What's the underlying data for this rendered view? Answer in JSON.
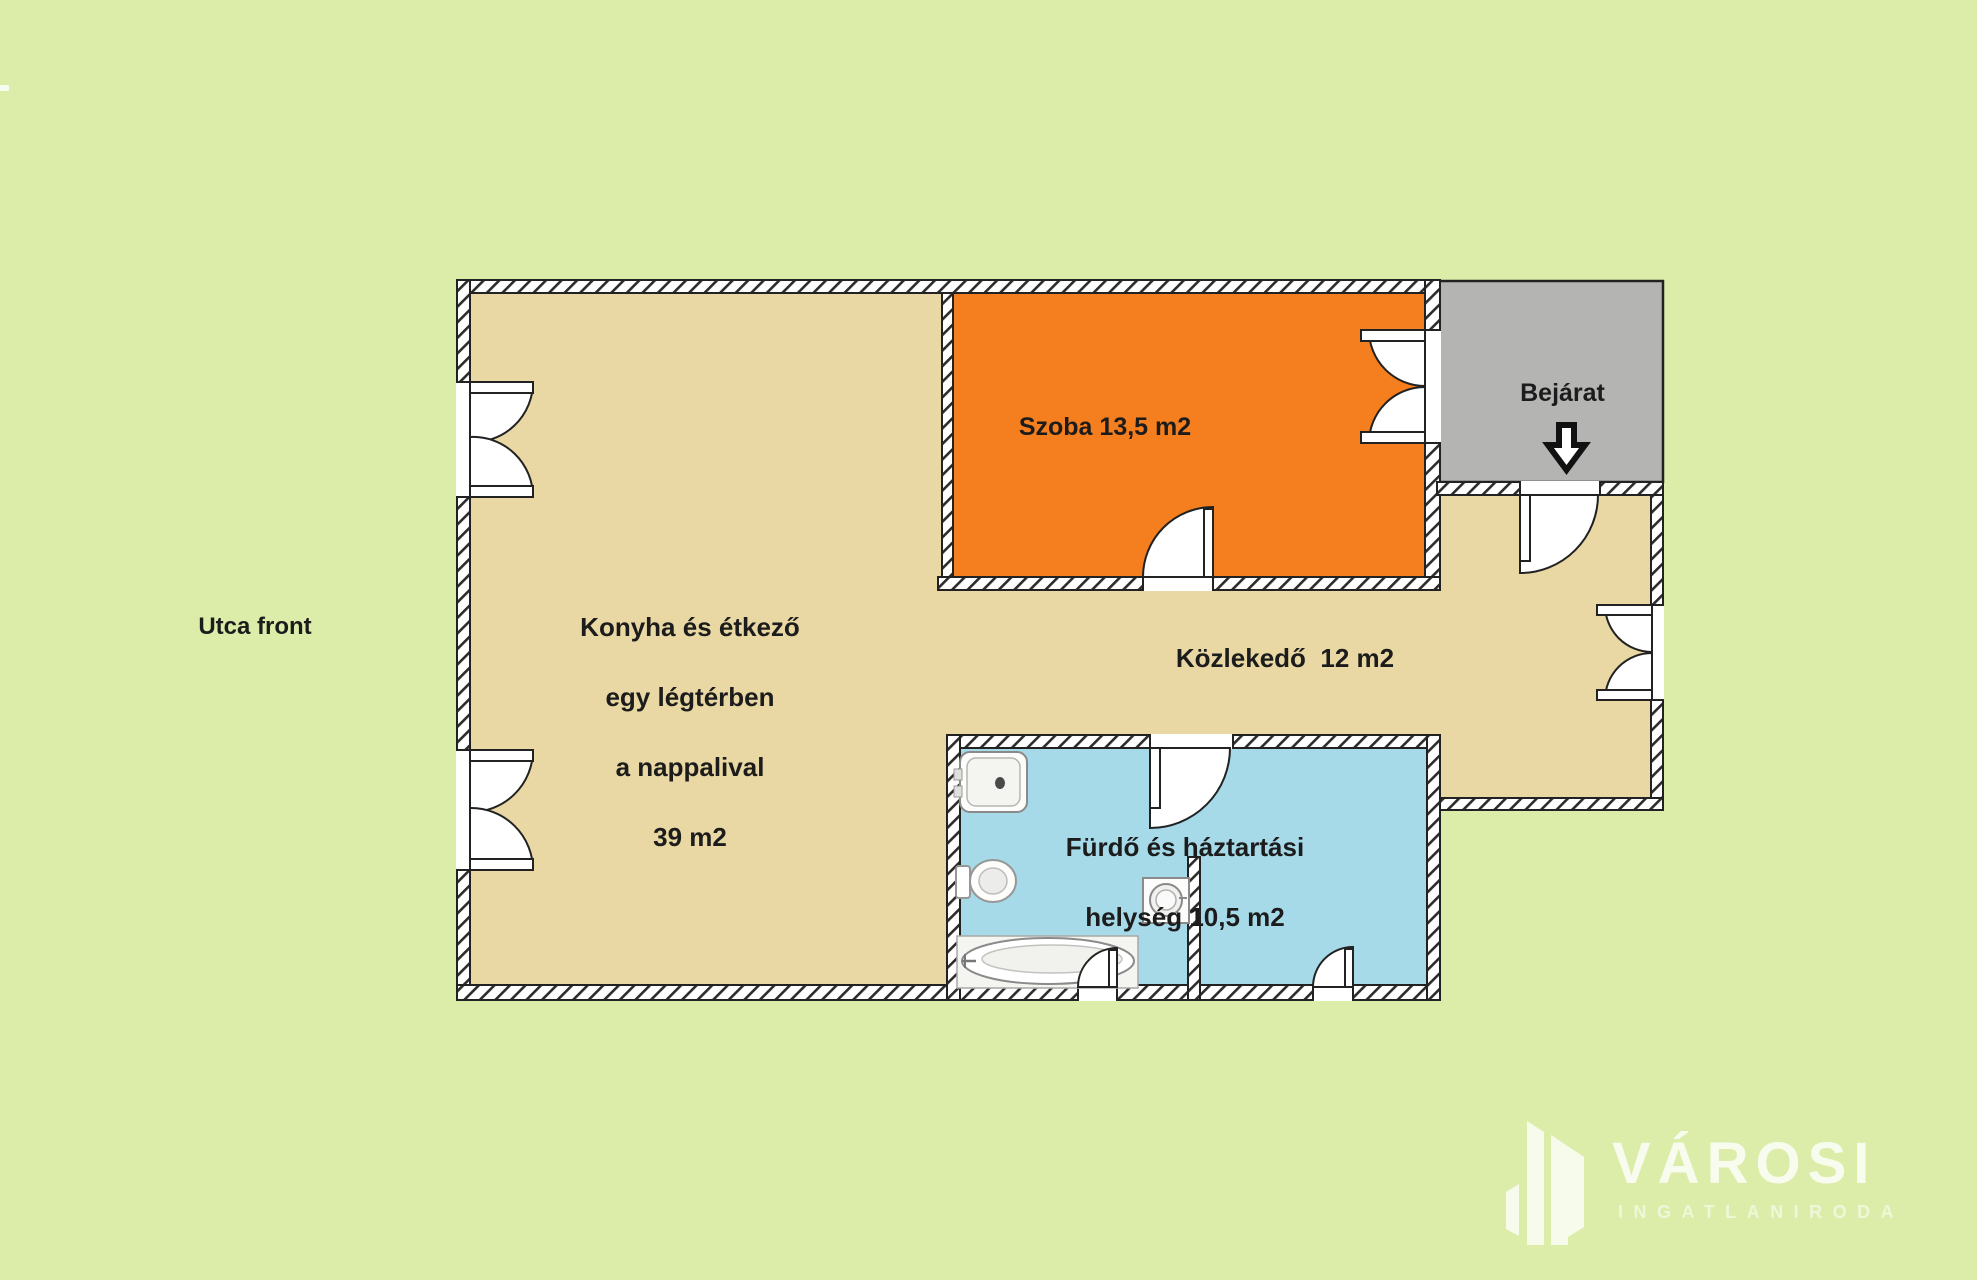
{
  "plan_title": "apartment floor plan",
  "outside": {
    "street_front_label": "Utca front"
  },
  "rooms": {
    "konyha": {
      "label_lines": [
        "Konyha és étkező",
        "egy légtérben",
        "a nappalival",
        "39 m2"
      ],
      "area_m2": "39",
      "color": "#e9d8a3"
    },
    "szoba": {
      "label": "Szoba 13,5 m2",
      "area_m2": "13,5",
      "color": "#f57e1e"
    },
    "kozlekedo": {
      "label": "Közlekedő  12 m2",
      "area_m2": "12",
      "color": "#e9d8a3"
    },
    "furdo": {
      "label_lines": [
        "Fürdő és háztartási",
        "helység 10,5 m2"
      ],
      "area_m2": "10,5",
      "color": "#a6dae9"
    },
    "bejarat": {
      "label": "Bejárat",
      "color": "#b4b4b2"
    }
  },
  "icons": {
    "entrance_direction": "down-arrow-icon",
    "fixtures": [
      "sink-icon",
      "toilet-icon",
      "bathtub-icon",
      "washing-machine-icon"
    ],
    "logo_mark": "buildings-icon"
  },
  "logo": {
    "brand": "VÁROSI",
    "subtitle": "INGATLANIRODA"
  },
  "colors": {
    "background": "#dcedaa",
    "floor": "#e9d8a3",
    "room_orange": "#f57e1e",
    "bathroom_blue": "#a6dae9",
    "entrance_gray": "#b4b4b2",
    "wall_line": "#222222",
    "text": "#1c1c1c",
    "logo_white": "rgba(255,255,255,0.8)"
  }
}
